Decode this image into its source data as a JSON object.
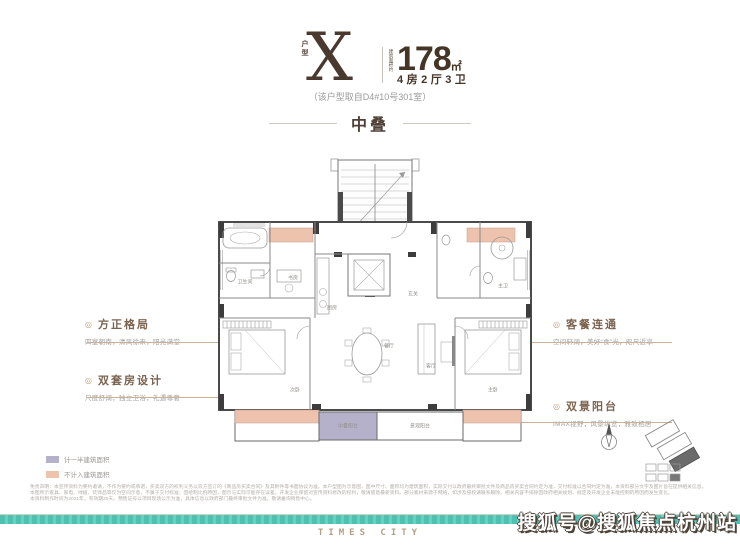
{
  "header": {
    "type_label": "户型",
    "type_value": "X",
    "area_label": "建筑面积约",
    "area_value": "178",
    "area_unit": "㎡",
    "layout_spec": "4房2厅3卫",
    "source_note": "（该户型取自D4#10号301室）"
  },
  "section": {
    "title": "中叠"
  },
  "annotations": {
    "left": [
      {
        "bullet": "◎",
        "title": "方正格局",
        "subtitle": "四室朝南，清风徐来，阳光满堂"
      },
      {
        "bullet": "◎",
        "title": "双套房设计",
        "subtitle": "尺度舒阔，独立卫浴，礼遇尊奢"
      }
    ],
    "right": [
      {
        "bullet": "◎",
        "title": "客餐连通",
        "subtitle": "空间轩阔，美好“食”光，咫尺近享"
      },
      {
        "bullet": "◎",
        "title": "双景阳台",
        "subtitle": "IMAX视野，风景纵览，雅致栖居"
      }
    ]
  },
  "floor_plan": {
    "rooms": [
      {
        "label": "卫生间",
        "x": 30,
        "y": 124
      },
      {
        "label": "书房",
        "x": 78,
        "y": 120
      },
      {
        "label": "厨房",
        "x": 117,
        "y": 150
      },
      {
        "label": "玄关",
        "x": 198,
        "y": 136
      },
      {
        "label": "主卫",
        "x": 288,
        "y": 128
      },
      {
        "label": "次卧",
        "x": 80,
        "y": 232
      },
      {
        "label": "主卧",
        "x": 278,
        "y": 232
      },
      {
        "label": "餐厅",
        "x": 174,
        "y": 188
      },
      {
        "label": "客厅",
        "x": 216,
        "y": 208
      },
      {
        "label": "中叠阳台",
        "x": 133,
        "y": 268
      },
      {
        "label": "景观阳台",
        "x": 205,
        "y": 268
      }
    ],
    "highlight_colors": {
      "half_area": "#b6b1ca",
      "excluded_area": "#eec3ae"
    }
  },
  "legend": {
    "items": [
      {
        "label": "计一半建筑面积",
        "color": "#b6b1ca"
      },
      {
        "label": "不计入建筑面积",
        "color": "#eec3ae"
      }
    ]
  },
  "disclaimer": {
    "lines": [
      "免责声明：本宣传资料为要约邀请，不作为要约或承诺，买卖双方的权利义务以双方签订的《商品房买卖合同》及其附件等书面协议为准。本户型图为示意图，图中尺寸、面积均为建筑面积，实际交付以政府最终审批文件及商品房买卖合同约定为准，交付标准以合同约定为准，本资料部分文字及图片旨在提供相关信息。",
      "本图所示家具、家电、绿植、装饰品等仅为空间示意，不属于交付标准；因绘制比例原因，图示与实际可能存在误差。开发企业保留对宣传资料修改的权利，敬请留意最新资料。部分素材来源于网络，如涉及侵权请联系删除。相关内容不排除因政府相关规划、规定及开发企业未能控制的原因而发生变化。",
      "本资料制作时间为2021年，有效期30天。预售证号以项目现场公示为准，具体信息以政府部门最终审批文件为准，敬请垂询销售中心。"
    ]
  },
  "footer": {
    "brand": "TIMES CITY"
  },
  "watermark": {
    "text": "搜狐号@搜狐焦点杭州站"
  },
  "colors": {
    "accent_brown": "#49392e",
    "leader_line": "#cdb197",
    "teal_band": "#4fc0b2",
    "brand_tan": "#b2a085"
  }
}
